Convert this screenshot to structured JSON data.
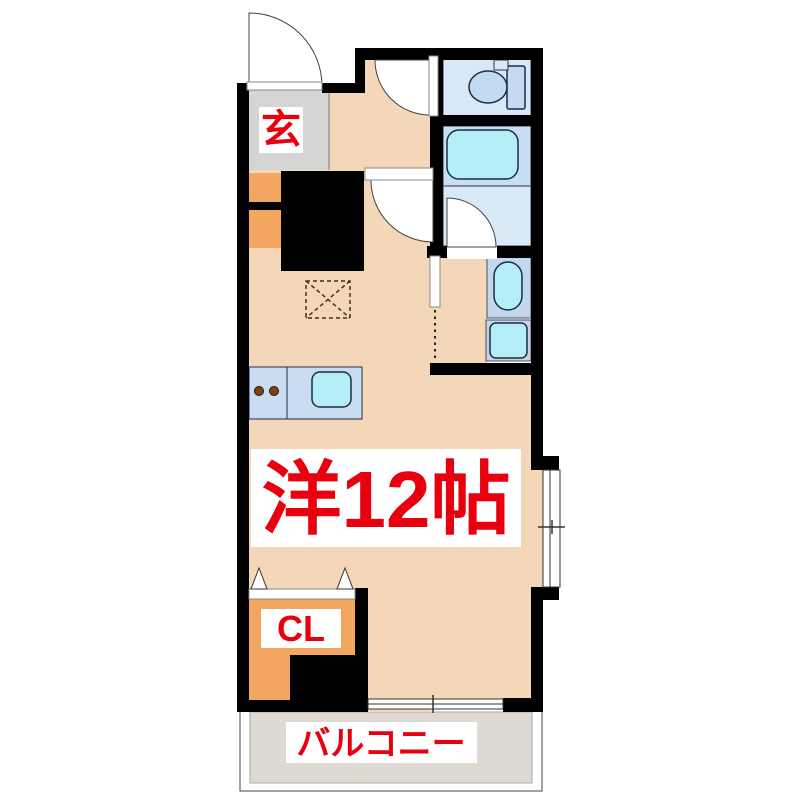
{
  "floorplan": {
    "title": "1R apartment floor plan",
    "labels": {
      "genkan": "玄",
      "main_room": "洋12帖",
      "closet": "CL",
      "balcony": "バルコニー"
    },
    "colors": {
      "wall": "#000000",
      "floor": "#F4D6B8",
      "genkan": "#D5D5D5",
      "orange": "#F2A660",
      "toilet_floor": "#D9E8F8",
      "bath_upper": "#C8DEF4",
      "bath_lower": "#D9E9F7",
      "fixture_blue": "#C4DAF2",
      "cyan": "#B5EFF6",
      "counter": "#C9DCF2",
      "vanity_panel": "#C3D8EF",
      "washer_panel": "#C9D2DE",
      "balcony": "#DFD9D3",
      "red": "#E8000F",
      "burner": "#7A4213"
    }
  }
}
